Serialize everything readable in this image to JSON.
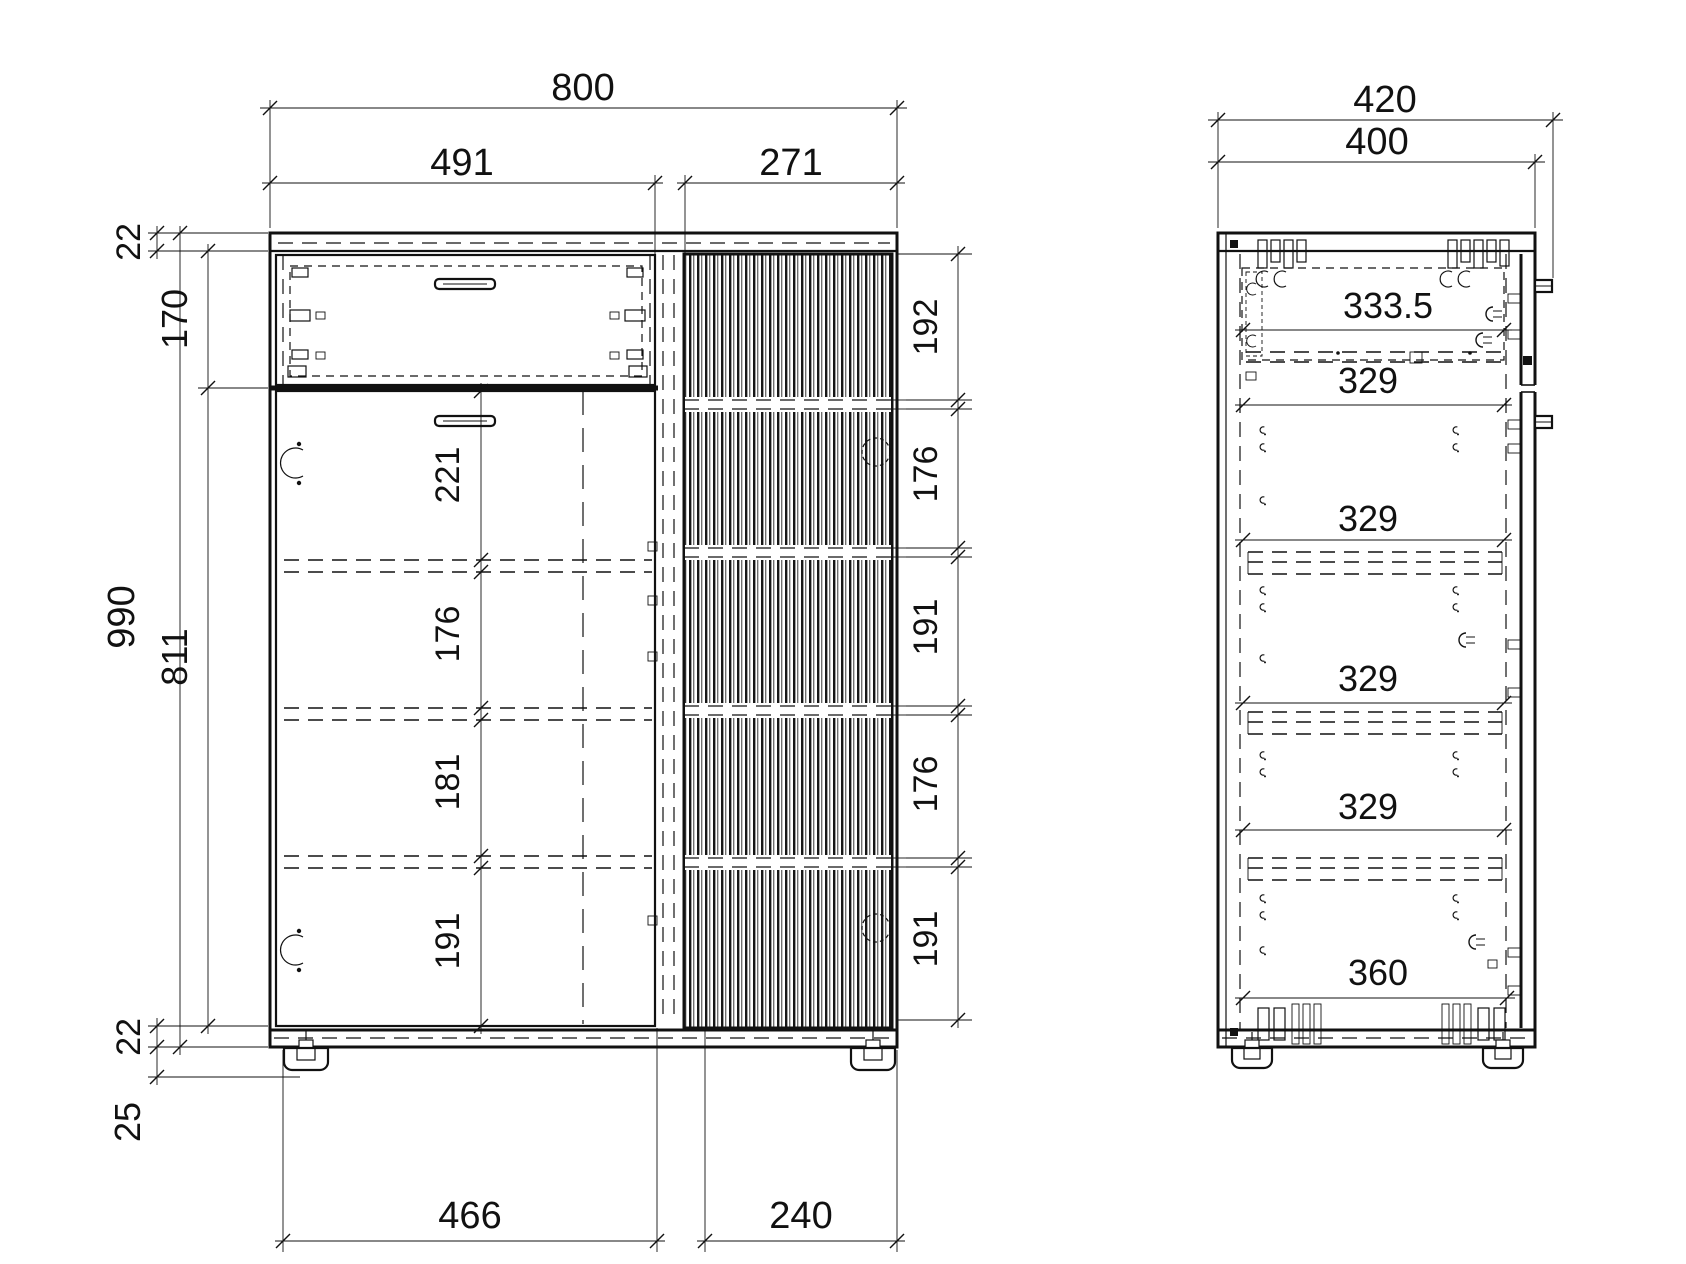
{
  "drawing": {
    "ink_color": "#111111",
    "paper_color": "#ffffff"
  },
  "front_view": {
    "width_total": "800",
    "width_left": "491",
    "width_right": "271",
    "top_panel": "22",
    "drawer_height": "170",
    "height_total": "990",
    "door_height": "811",
    "bottom_panel": "22",
    "foot_height": "25",
    "right_chain": [
      "192",
      "176",
      "191",
      "176",
      "191"
    ],
    "inner_chain": [
      "221",
      "176",
      "181",
      "191"
    ],
    "plinth_left": "466",
    "plinth_right": "240"
  },
  "side_view": {
    "depth_total": "420",
    "depth_body": "400",
    "inner_dims": [
      "333.5",
      "329",
      "329",
      "329",
      "329",
      "360"
    ]
  }
}
